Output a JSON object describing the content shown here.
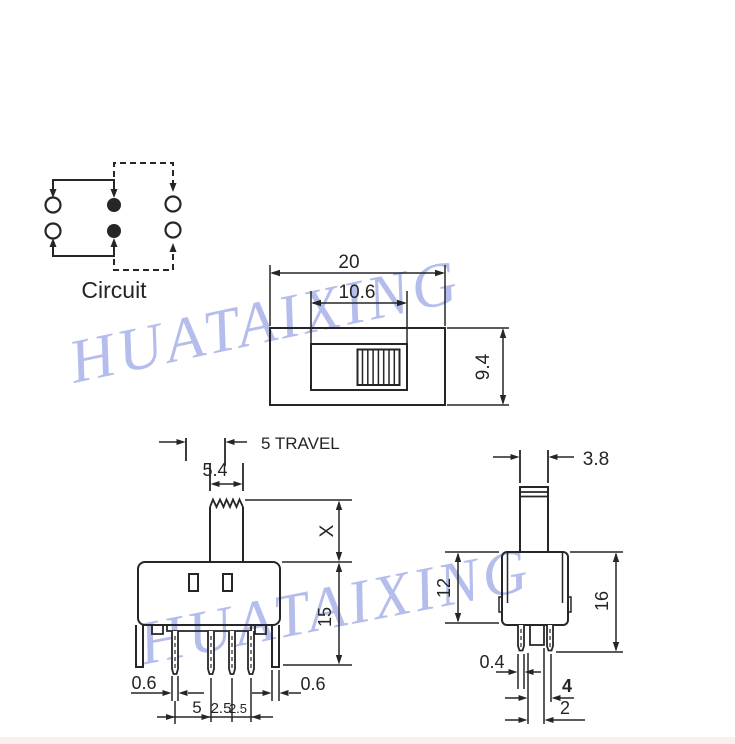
{
  "watermark": {
    "text": "HUATAIXING",
    "color": "#a8b2e8"
  },
  "colors": {
    "line": "#262626",
    "background": "#ffffff",
    "page_edge_tint": "#fbf0ee"
  },
  "drawing": {
    "circuit": {
      "label": "Circuit"
    },
    "top_view": {
      "overall_width": "20",
      "slot_width": "10.6",
      "overall_depth": "9.4"
    },
    "front_view": {
      "travel_label": "5 TRAVEL",
      "knob_width": "5.4",
      "knob_height": "X",
      "body_height": "15",
      "pin_width_left": "0.6",
      "pin_width_right": "0.6",
      "pin_pitch_1": "5",
      "pin_pitch_2": "2.5",
      "pin_pitch_3": "2.5"
    },
    "side_view": {
      "knob_depth": "3.8",
      "body_depth": "12",
      "overall_height": "16",
      "pin_thickness": "0.4",
      "pin_span": "4",
      "post_width": "2"
    }
  }
}
